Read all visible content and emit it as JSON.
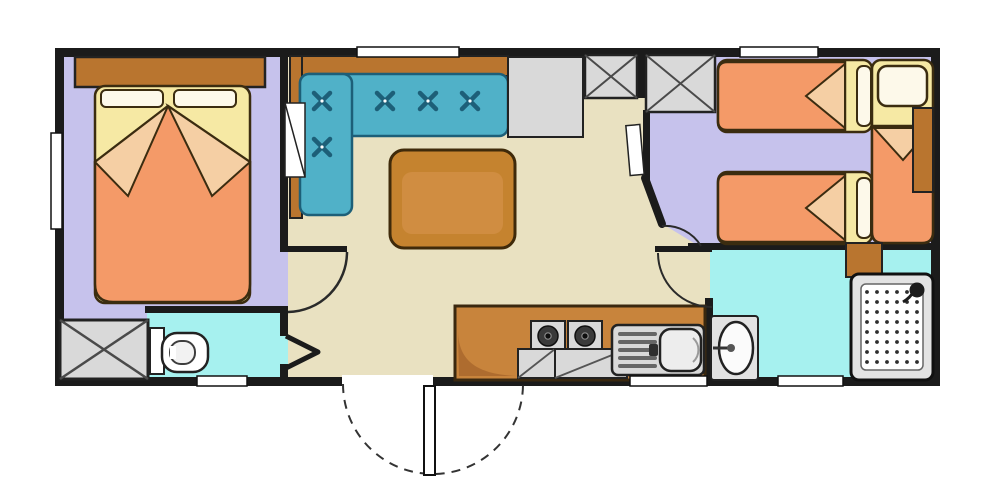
{
  "diagram": {
    "type": "floor-plan",
    "description_semantic": "mobile-home floor plan, top-down view, no text labels rendered",
    "rooms": [
      {
        "id": "master-bedroom",
        "floor": "lavender",
        "items": [
          "double-bed",
          "headboard-shelf",
          "corner-wardrobe",
          "wall-panel",
          "side-window"
        ]
      },
      {
        "id": "living-room",
        "floor": "beige",
        "items": [
          "l-shaped-sofa",
          "coffee-table",
          "storage-cabinet",
          "wardrobe",
          "wardrobe",
          "top-window"
        ]
      },
      {
        "id": "kitchen",
        "floor": "beige",
        "items": [
          "counter",
          "hob-two-burners",
          "sink-with-drainer",
          "under-counter-units",
          "bottom-window"
        ]
      },
      {
        "id": "toilet-room",
        "floor": "cyan",
        "items": [
          "wc",
          "folding-door",
          "bottom-window"
        ]
      },
      {
        "id": "twin-bedroom",
        "floor": "lavender",
        "items": [
          "single-bed",
          "single-bed",
          "single-bed-vertical",
          "bedside-cabinet",
          "top-window"
        ]
      },
      {
        "id": "shower-room",
        "floor": "cyan",
        "items": [
          "washbasin",
          "shower-tray",
          "cabinet",
          "bottom-window"
        ]
      }
    ],
    "counts": {
      "bed_units": 4,
      "x-marked_wardrobes": 3,
      "windows": 6,
      "door_swing_arcs": 4,
      "entrance_double_swing": 1
    },
    "sofa_button_count": 5,
    "hob_burner_count": 2
  },
  "colors": {
    "wall": "#1b1b1b",
    "lavender": "#c6c2ec",
    "beige": "#e9e1c1",
    "cyan": "#a6f1ef",
    "teal": "#50b1c8",
    "tealdark": "#1d5f78",
    "brown": "#b9752f",
    "tablebrown": "#c5832f",
    "counter": "#c8843c",
    "counterline": "#3a280f",
    "orange": "#f49a68",
    "fold": "#f5cfa4",
    "sheet": "#f6e9a4",
    "pillow": "#fdf9ea",
    "gray": "#d9d9d9",
    "grayline": "#222222",
    "bedline": "#3b2c10",
    "white": "#ffffff"
  }
}
